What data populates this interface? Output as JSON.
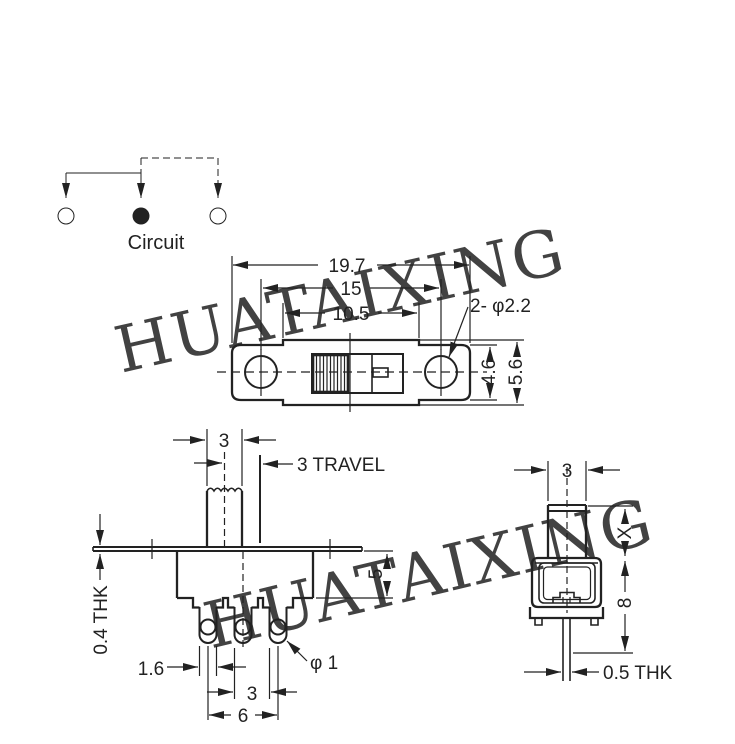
{
  "colors": {
    "line": "#222222",
    "watermark": "#a9b4f0",
    "background": "#ffffff"
  },
  "watermark": {
    "text": "HUATAIXING"
  },
  "circuit": {
    "label": "Circuit"
  },
  "top_view": {
    "overall_length": "19.7",
    "hole_pitch": "15",
    "body_length": "10.5",
    "holes_label": "2- φ2.2",
    "frame_width": "4.6",
    "body_width": "5.6"
  },
  "front_view": {
    "knob_width": "3",
    "travel_label": "3 TRAVEL",
    "body_height": "5",
    "frame_thickness": "0.4 THK",
    "terminal_width": "1.6",
    "terminal_hole": "φ 1",
    "terminal_pitch": "3",
    "terminal_span": "6"
  },
  "side_view": {
    "knob_width": "3",
    "knob_height": "X",
    "overall_height": "8",
    "terminal_thickness": "0.5 THK"
  }
}
